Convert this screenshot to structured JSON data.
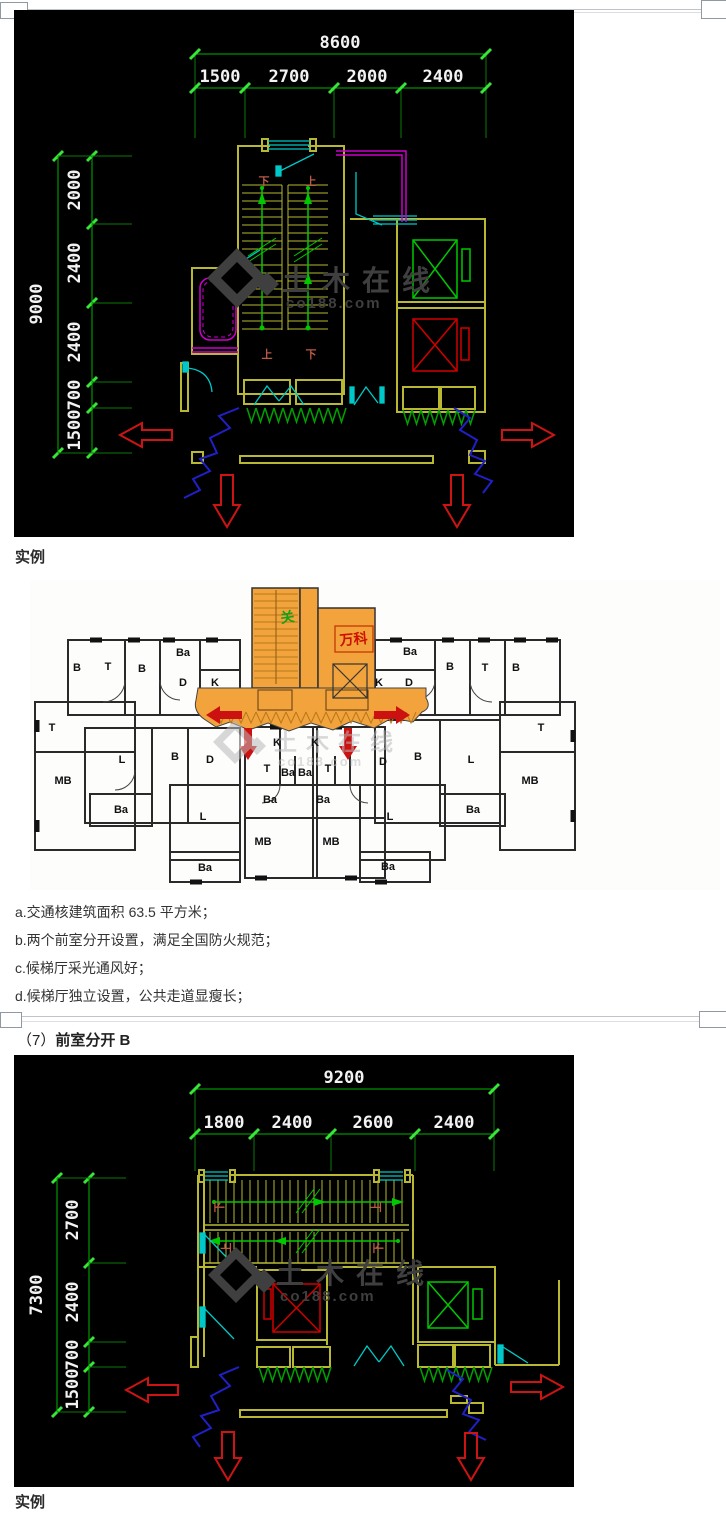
{
  "page": {
    "example_label_top": "实例",
    "example_label_bottom": "实例",
    "heading_prefix": "（7）",
    "heading_title": "前室分开 B",
    "notes": [
      "a.交通核建筑面积 63.5 平方米；",
      "b.两个前室分开设置，满足全国防火规范；",
      "c.候梯厅采光通风好；",
      "d.候梯厅独立设置，公共走道显瘦长；"
    ]
  },
  "watermark": {
    "cn": "土木在线",
    "en": "co188.com"
  },
  "cad_plan_a": {
    "dims_top": {
      "total": "8600",
      "segments": [
        "1500",
        "2700",
        "2000",
        "2400"
      ]
    },
    "dims_left": {
      "total": "9000",
      "segments": [
        "2000",
        "2400",
        "2400",
        "700",
        "1500"
      ]
    },
    "stair_labels": {
      "top_left": "下",
      "top_right": "上",
      "bottom_left": "上",
      "bottom_right": "下"
    }
  },
  "floor_plan": {
    "core_label_green": "关",
    "core_label_red": "万科",
    "rooms": [
      {
        "label": "B",
        "x": 47,
        "y": 88
      },
      {
        "label": "T",
        "x": 78,
        "y": 87
      },
      {
        "label": "B",
        "x": 112,
        "y": 89
      },
      {
        "label": "Ba",
        "x": 153,
        "y": 73
      },
      {
        "label": "D",
        "x": 153,
        "y": 103
      },
      {
        "label": "K",
        "x": 185,
        "y": 103
      },
      {
        "label": "T",
        "x": 22,
        "y": 148
      },
      {
        "label": "MB",
        "x": 33,
        "y": 201
      },
      {
        "label": "L",
        "x": 92,
        "y": 180
      },
      {
        "label": "B",
        "x": 145,
        "y": 177
      },
      {
        "label": "D",
        "x": 180,
        "y": 180
      },
      {
        "label": "Ba",
        "x": 91,
        "y": 230
      },
      {
        "label": "L",
        "x": 173,
        "y": 237
      },
      {
        "label": "Ba",
        "x": 175,
        "y": 288
      },
      {
        "label": "K",
        "x": 247,
        "y": 163
      },
      {
        "label": "K",
        "x": 285,
        "y": 163
      },
      {
        "label": "T",
        "x": 237,
        "y": 189
      },
      {
        "label": "Ba",
        "x": 258,
        "y": 193
      },
      {
        "label": "Ba",
        "x": 275,
        "y": 193
      },
      {
        "label": "T",
        "x": 298,
        "y": 189
      },
      {
        "label": "Ba",
        "x": 240,
        "y": 220
      },
      {
        "label": "Ba",
        "x": 293,
        "y": 220
      },
      {
        "label": "MB",
        "x": 233,
        "y": 262
      },
      {
        "label": "MB",
        "x": 301,
        "y": 262
      },
      {
        "label": "Ba",
        "x": 380,
        "y": 72
      },
      {
        "label": "K",
        "x": 349,
        "y": 103
      },
      {
        "label": "D",
        "x": 379,
        "y": 103
      },
      {
        "label": "B",
        "x": 420,
        "y": 87
      },
      {
        "label": "T",
        "x": 455,
        "y": 88
      },
      {
        "label": "B",
        "x": 486,
        "y": 88
      },
      {
        "label": "T",
        "x": 511,
        "y": 148
      },
      {
        "label": "MB",
        "x": 500,
        "y": 201
      },
      {
        "label": "L",
        "x": 441,
        "y": 180
      },
      {
        "label": "B",
        "x": 388,
        "y": 177
      },
      {
        "label": "D",
        "x": 353,
        "y": 182
      },
      {
        "label": "L",
        "x": 360,
        "y": 237
      },
      {
        "label": "Ba",
        "x": 443,
        "y": 230
      },
      {
        "label": "Ba",
        "x": 358,
        "y": 287
      }
    ]
  },
  "cad_plan_b": {
    "dims_top": {
      "total": "9200",
      "segments": [
        "1800",
        "2400",
        "2600",
        "2400"
      ]
    },
    "dims_left": {
      "total": "7300",
      "segments": [
        "2700",
        "2400",
        "700",
        "1500"
      ]
    },
    "stair_labels": {
      "run1_left": "下",
      "run1_right": "上",
      "run2_left": "上",
      "run2_right": "下"
    }
  },
  "colors": {
    "cad_background": "#000000",
    "dimension_green": "#00b400",
    "wall_yellow": "#b8b832",
    "elevator_green": "#00c800",
    "elevator_red": "#d00000",
    "door_cyan": "#00c8c8",
    "bath_magenta": "#cc00cc",
    "break_blue": "#2020c8",
    "arrow_red": "#cc1414",
    "core_orange": "#f2a33c"
  }
}
